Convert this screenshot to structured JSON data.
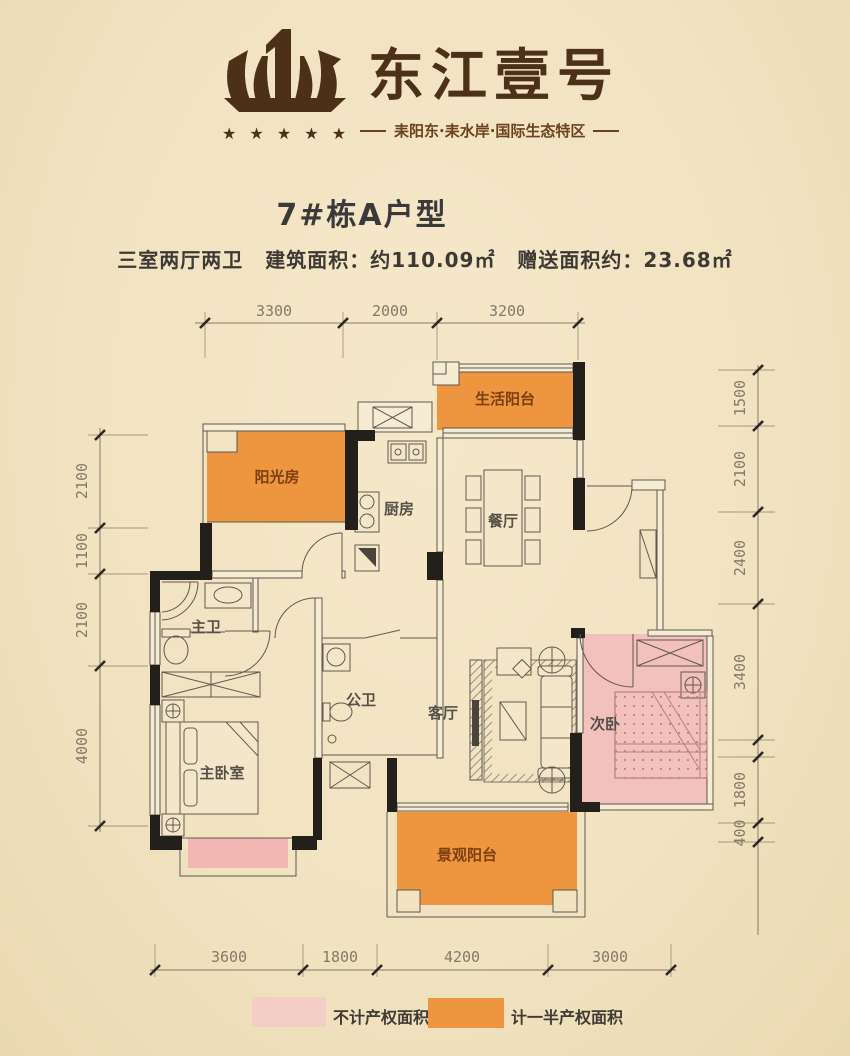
{
  "brand": {
    "name": "东江壹号",
    "tagline": "耒阳东·耒水岸·国际生态特区",
    "stars": "★ ★ ★ ★ ★"
  },
  "header": {
    "title": "7#栋A户型",
    "spec": "三室两厅两卫",
    "area": "建筑面积：约110.09㎡",
    "gift": "赠送面积约：23.68㎡"
  },
  "rooms": {
    "service_balcony": "生活阳台",
    "sunroom": "阳光房",
    "kitchen": "厨房",
    "dining": "餐厅",
    "master_bath": "主卫",
    "guest_bath": "公卫",
    "living": "客厅",
    "second_bedroom": "次卧",
    "master_bedroom": "主卧室",
    "view_balcony": "景观阳台"
  },
  "dims": {
    "top": [
      "3300",
      "2000",
      "3200"
    ],
    "left": [
      "2100",
      "1100",
      "2100",
      "4000"
    ],
    "right": [
      "1500",
      "2100",
      "2400",
      "3400",
      "1800",
      "400"
    ],
    "bottom": [
      "3600",
      "1800",
      "4200",
      "3000"
    ]
  },
  "legend": {
    "pink": "不计产权面积",
    "orange": "计一半产权面积"
  },
  "colors": {
    "orange": "#ee9540",
    "pink_room": "#f3c1bc",
    "pink_bay": "#f2b7b2",
    "legend_pink": "#f5cdc7",
    "wall": "#23201b",
    "cream": "#f2e4c2",
    "logo_brown": "#4c3118"
  }
}
